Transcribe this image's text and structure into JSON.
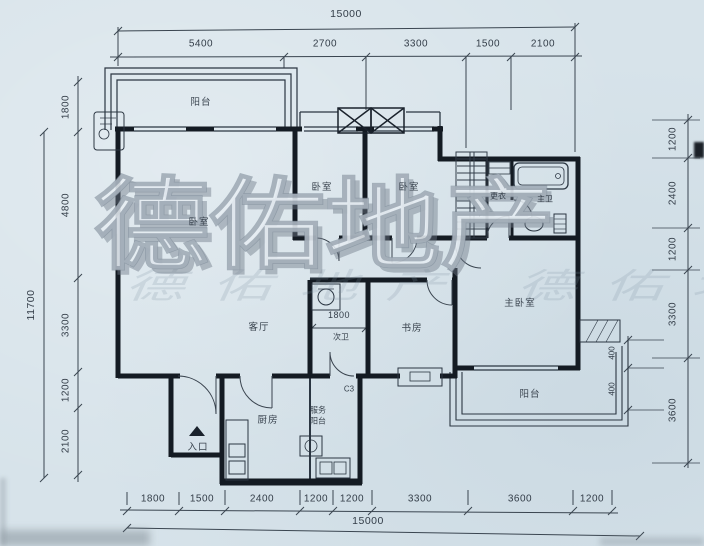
{
  "watermark": {
    "primary": "德佑地产",
    "secondary": "德佑地产 德佑地产"
  },
  "rooms": {
    "balcony_top": "阳台",
    "bedroom_left": "卧室",
    "bedroom_a": "卧室",
    "bedroom_b": "卧室",
    "dressing": "更衣",
    "master_bath": "主卫",
    "living": "客厅",
    "second_bath": "次卫",
    "study": "书房",
    "master_bedroom": "主卧室",
    "kitchen": "厨房",
    "service_balcony_line1": "服务",
    "service_balcony_line2": "阳台",
    "balcony_bottom": "阳台",
    "entrance": "入口",
    "window_code": "C3"
  },
  "dimensions": {
    "top": {
      "total": "15000",
      "segments": [
        "5400",
        "2700",
        "3300",
        "1500",
        "2100"
      ]
    },
    "bottom": {
      "total": "15000",
      "segments": [
        "1800",
        "1500",
        "2400",
        "1200",
        "1200",
        "3300",
        "3600",
        "1200"
      ]
    },
    "left": {
      "total": "11700",
      "segments": [
        "1800",
        "4800",
        "3300",
        "1200",
        "2100"
      ]
    },
    "right": {
      "segments": [
        "1200",
        "2400",
        "1200",
        "3300",
        "3600"
      ]
    },
    "balcony_side": [
      "400",
      "400"
    ],
    "inner_bath": "1800"
  },
  "colors": {
    "paper": "#d7e3ea",
    "ink": "#2e3844",
    "wall": "#141b23"
  }
}
